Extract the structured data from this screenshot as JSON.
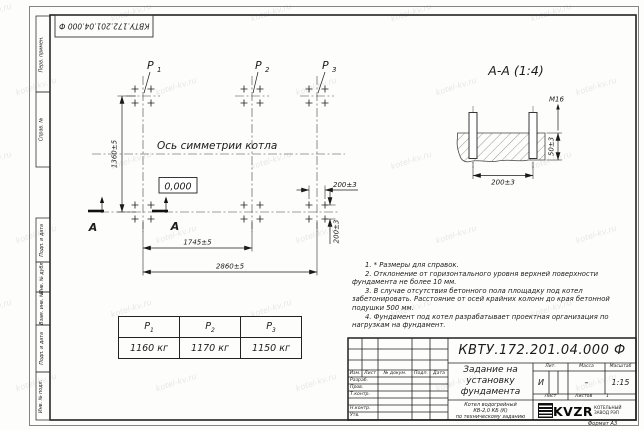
{
  "watermark": "kotel-kv.ru",
  "stamp_top": "КВТУ.172.201.04.000 Ф",
  "format_label": "Формат А3",
  "frame_labels": {
    "l1": "Перв. примен.",
    "l2": "Справ. №",
    "l3": "Подп. и дата",
    "l4": "Инв. № дубл.",
    "l5": "Взам. инв. №",
    "l6": "Подп. и дата",
    "l7": "Инв. № подл."
  },
  "plan": {
    "p_letter": "P",
    "points": [
      "1",
      "2",
      "3"
    ],
    "axis_label": "Ось симметрии котла",
    "elevation": "0,000",
    "dim_height": "1360±5",
    "dim_span1": "1745±5",
    "dim_span2": "2860±5",
    "dim_bolt_x": "200±3",
    "dim_bolt_y": "200±3",
    "section_letter": "А"
  },
  "section": {
    "title": "А-А (1:4)",
    "bolt": "М16",
    "dim_h": "50±3",
    "dim_w": "200±3"
  },
  "notes": [
    "1. * Размеры для справок.",
    "2. Отклонение от горизонтального уровня верхней поверхности фундамента не более 10 мм.",
    "3. В случае отсутствия бетонного пола площадку под котел забетонировать. Расстояние от осей крайних колонн до края бетонной подушки 500 мм.",
    "4. Фундамент под котел разрабатывает проектная организация по нагрузкам на фундамент."
  ],
  "load_table": {
    "values": [
      "1160 кг",
      "1170 кг",
      "1150 кг"
    ]
  },
  "title_block": {
    "doc_number": "КВТУ.172.201.04.000 Ф",
    "doc_title": "Задание на\nустановку\nфундамента",
    "rev": {
      "izm": "Изм.",
      "list": "Лист",
      "doc": "№ докум.",
      "podp": "Подп.",
      "data": "Дата"
    },
    "roles": {
      "r1": "Разраб.",
      "r2": "Пров.",
      "r3": "Т.контр.",
      "r4": "Н.контр.",
      "r5": "Утв."
    },
    "lit": {
      "h": "Лит.",
      "v": "И"
    },
    "mass": {
      "h": "Масса",
      "v": "–"
    },
    "scale": {
      "h": "Масштаб",
      "v": "1:15"
    },
    "sheet": {
      "h": "Лист",
      "total_h": "Листов",
      "total_v": "1"
    },
    "product": "Котел водогрейный\nКВ-2,0 КБ (К)\nпо техническому заданию",
    "company": {
      "logo": "KVZR",
      "line1": "КОТЕЛЬНЫЙ",
      "line2": "ЗАВОД РЭП"
    }
  }
}
